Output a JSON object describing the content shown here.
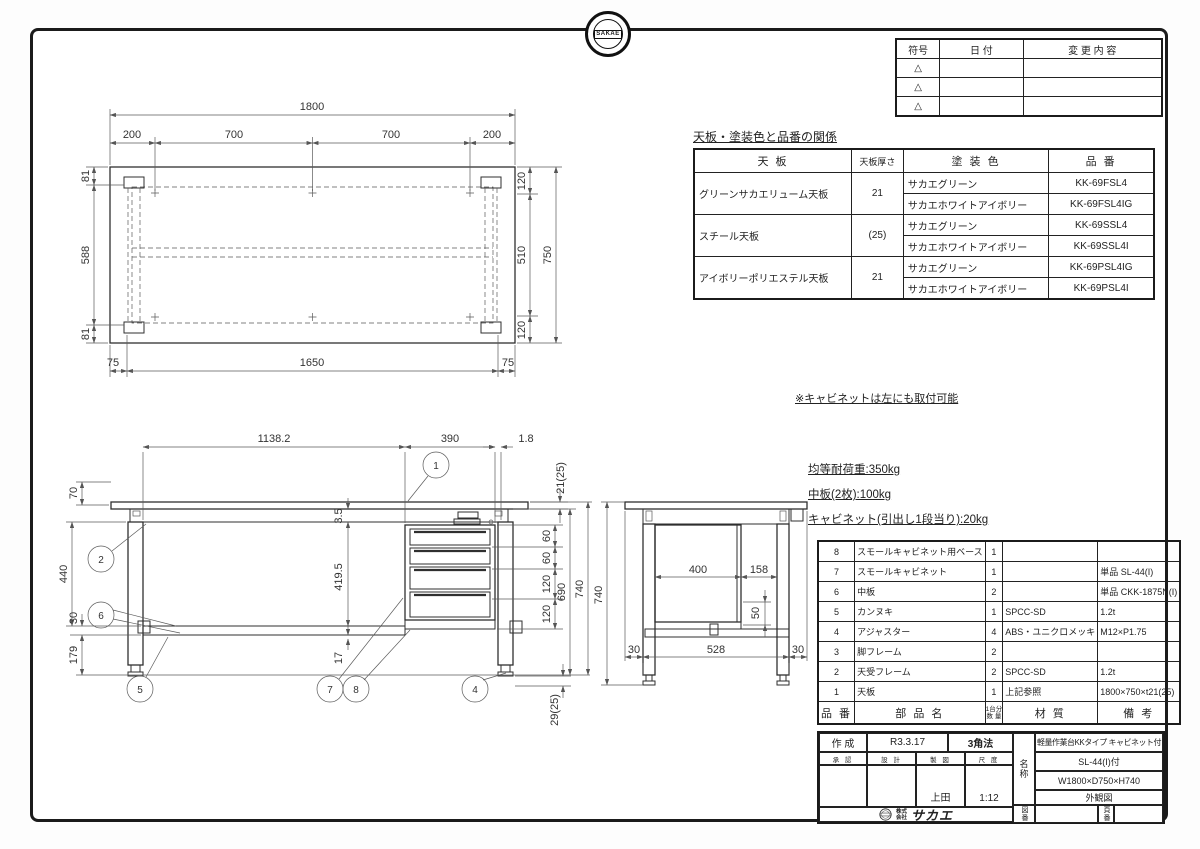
{
  "badge": {
    "logo_text": "SAKAE"
  },
  "revision_table": {
    "headers": {
      "sym": "符号",
      "date": "日  付",
      "change": "変  更  内  容"
    },
    "symbol": "△"
  },
  "paint_table": {
    "title": "天板・塗装色と品番の関係",
    "headers": {
      "top": "天  板",
      "thickness": "天板厚さ",
      "color": "塗  装  色",
      "code": "品  番"
    },
    "rows": [
      {
        "top": "グリーンサカエリューム天板",
        "thickness": "21",
        "colors": [
          {
            "color": "サカエグリーン",
            "code": "KK-69FSL4"
          },
          {
            "color": "サカエホワイトアイボリー",
            "code": "KK-69FSL4IG"
          }
        ]
      },
      {
        "top": "スチール天板",
        "thickness": "(25)",
        "colors": [
          {
            "color": "サカエグリーン",
            "code": "KK-69SSL4"
          },
          {
            "color": "サカエホワイトアイボリー",
            "code": "KK-69SSL4I"
          }
        ]
      },
      {
        "top": "アイボリーポリエステル天板",
        "thickness": "21",
        "colors": [
          {
            "color": "サカエグリーン",
            "code": "KK-69PSL4IG"
          },
          {
            "color": "サカエホワイトアイボリー",
            "code": "KK-69PSL4I"
          }
        ]
      }
    ]
  },
  "cabinet_note": "※キャビネットは左にも取付可能",
  "load_notes": [
    "均等耐荷重:350kg",
    "中板(2枚):100kg",
    "キャビネット(引出し1段当り):20kg"
  ],
  "parts_table": {
    "headers": {
      "no": "品 番",
      "name": "部  品  名",
      "qty_top": "1台分",
      "qty_bottom": "数 量",
      "material": "材  質",
      "remark": "備  考"
    },
    "rows": [
      {
        "no": "8",
        "name": "スモールキャビネット用ベース",
        "qty": "1",
        "material": "",
        "remark": ""
      },
      {
        "no": "7",
        "name": "スモールキャビネット",
        "qty": "1",
        "material": "",
        "remark": "単品 SL-44(I)"
      },
      {
        "no": "6",
        "name": "中板",
        "qty": "2",
        "material": "",
        "remark": "単品 CKK-1875N(I)"
      },
      {
        "no": "5",
        "name": "カンヌキ",
        "qty": "1",
        "material": "SPCC-SD",
        "remark": "1.2t"
      },
      {
        "no": "4",
        "name": "アジャスター",
        "qty": "4",
        "material": "ABS・ユニクロメッキ",
        "remark": "M12×P1.75"
      },
      {
        "no": "3",
        "name": "脚フレーム",
        "qty": "2",
        "material": "",
        "remark": ""
      },
      {
        "no": "2",
        "name": "天受フレーム",
        "qty": "2",
        "material": "SPCC-SD",
        "remark": "1.2t"
      },
      {
        "no": "1",
        "name": "天板",
        "qty": "1",
        "material": "上記参照",
        "remark": "1800×750×t21(25)"
      }
    ]
  },
  "title_block": {
    "created_label": "作 成",
    "created_date": "R3.3.17",
    "projection": "3角法",
    "approve_label": "承 認",
    "design_label": "設 計",
    "draft_label": "製 図",
    "scale_label": "尺 度",
    "drafter": "上田",
    "scale": "1:12",
    "name_label": "名称",
    "product_line1": "軽量作業台KKタイプ キャビネット付",
    "product_line2": "SL-44(I)付",
    "product_line3": "W1800×D750×H740",
    "product_line4": "外観図",
    "company_top": "株式",
    "company_bottom": "会社",
    "company_name": "サカエ",
    "drawing_no_label": "図番",
    "page_no_label": "頁番"
  },
  "drawings": {
    "plan": {
      "total_w": "1800",
      "seg1": "200",
      "seg2": "700",
      "seg3": "700",
      "seg4": "200",
      "left1": "81",
      "left2": "588",
      "left3": "81",
      "right1": "120",
      "right2": "510",
      "right3": "120",
      "depth": "750",
      "bot1": "75",
      "bot2": "1650",
      "bot3": "75"
    },
    "front": {
      "w1": "1138.2",
      "w2": "390",
      "w3": "1.8",
      "t": "21(25)",
      "h1": "70",
      "h2": "440",
      "h3": "30",
      "h4": "179",
      "g1": "3.5",
      "g2": "419.5",
      "g3": "17",
      "dr1": "60",
      "dr2": "60",
      "dr3": "120",
      "dr4": "120",
      "h5": "690",
      "h6": "740",
      "adj": "29(25)",
      "b1": "1",
      "b2": "2",
      "b4": "4",
      "b5": "5",
      "b6": "6",
      "b7": "7",
      "b8": "8"
    },
    "side": {
      "d1": "400",
      "d2": "158",
      "d3": "50",
      "b1": "30",
      "b2": "528",
      "b3": "30",
      "h": "740"
    }
  }
}
